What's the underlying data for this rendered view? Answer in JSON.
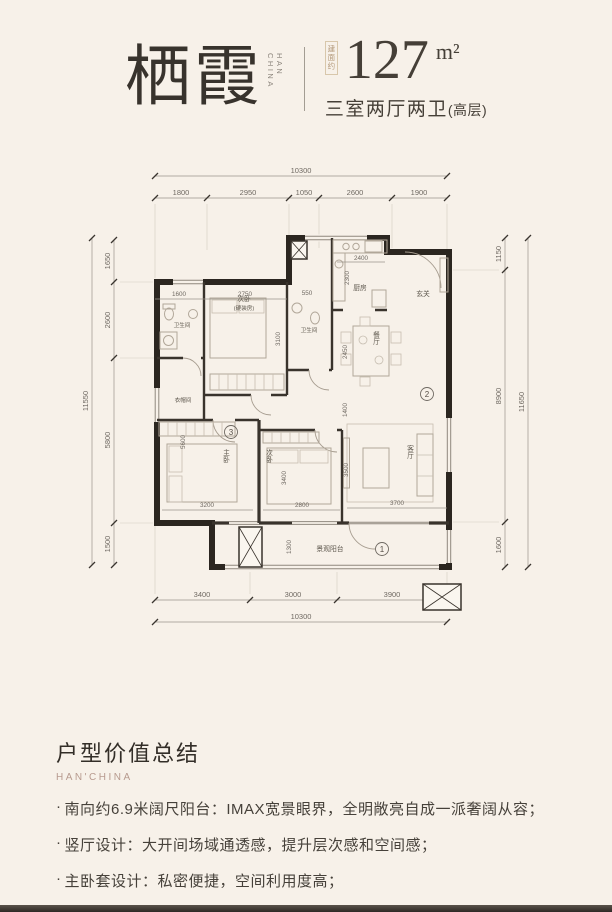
{
  "header": {
    "title": "栖霞",
    "brand_vertical": "HAN CHINA",
    "area_prefix": "建面约",
    "area_value": "127",
    "area_unit": "m²",
    "subtitle": "三室两厅两卫",
    "subtitle_note": "(高层)"
  },
  "floorplan": {
    "top_total": "10300",
    "top_segments": [
      "1800",
      "2950",
      "1050",
      "2600",
      "1900"
    ],
    "bottom_segments": [
      "3400",
      "3000",
      "3900"
    ],
    "bottom_total": "10300",
    "left_total": "11550",
    "left_segments": [
      "1650",
      "2600",
      "5800",
      "1500"
    ],
    "right_segments": [
      "1150",
      "8900",
      "1600"
    ],
    "right_total": "11650",
    "rooms": {
      "kitchen": "厨房",
      "entry": "玄关",
      "dining": "餐厅",
      "living": "客厅",
      "balcony": "景观阳台",
      "master": "主卧",
      "bedroom2": "次卧",
      "bedroom3_line1": "次卧",
      "bedroom3_line2": "(硬装房)",
      "bath1": "卫生间",
      "bath2": "卫生间",
      "cloak": "衣帽间"
    },
    "dims": {
      "bath1_w": "1600",
      "bed3_w": "2750",
      "bed3_h": "3100",
      "bath2_w": "550",
      "kitchen_w": "2400",
      "kitchen_h": "2300",
      "dining_h": "2450",
      "hall_h": "1400",
      "living_h": "3500",
      "living_w": "3700",
      "master_h": "5600",
      "master_w": "3200",
      "bed2_h": "3400",
      "bed2_w": "2800",
      "balcony_h": "1300"
    },
    "markers": {
      "balcony": "1",
      "dining": "2",
      "master": "3"
    }
  },
  "summary": {
    "heading": "户型价值总结",
    "brand": "HAN'CHINA",
    "bullet_char": "·",
    "bullets": [
      "南向约6.9米阔尺阳台：IMAX宽景眼界，全明敞亮自成一派奢阔从容；",
      "竖厅设计：大开间场域通透感，提升层次感和空间感；",
      "主卧套设计：私密便捷，空间利用度高；",
      "干湿分离卫浴：全明双卫干湿分离，定制品质生活；"
    ]
  }
}
